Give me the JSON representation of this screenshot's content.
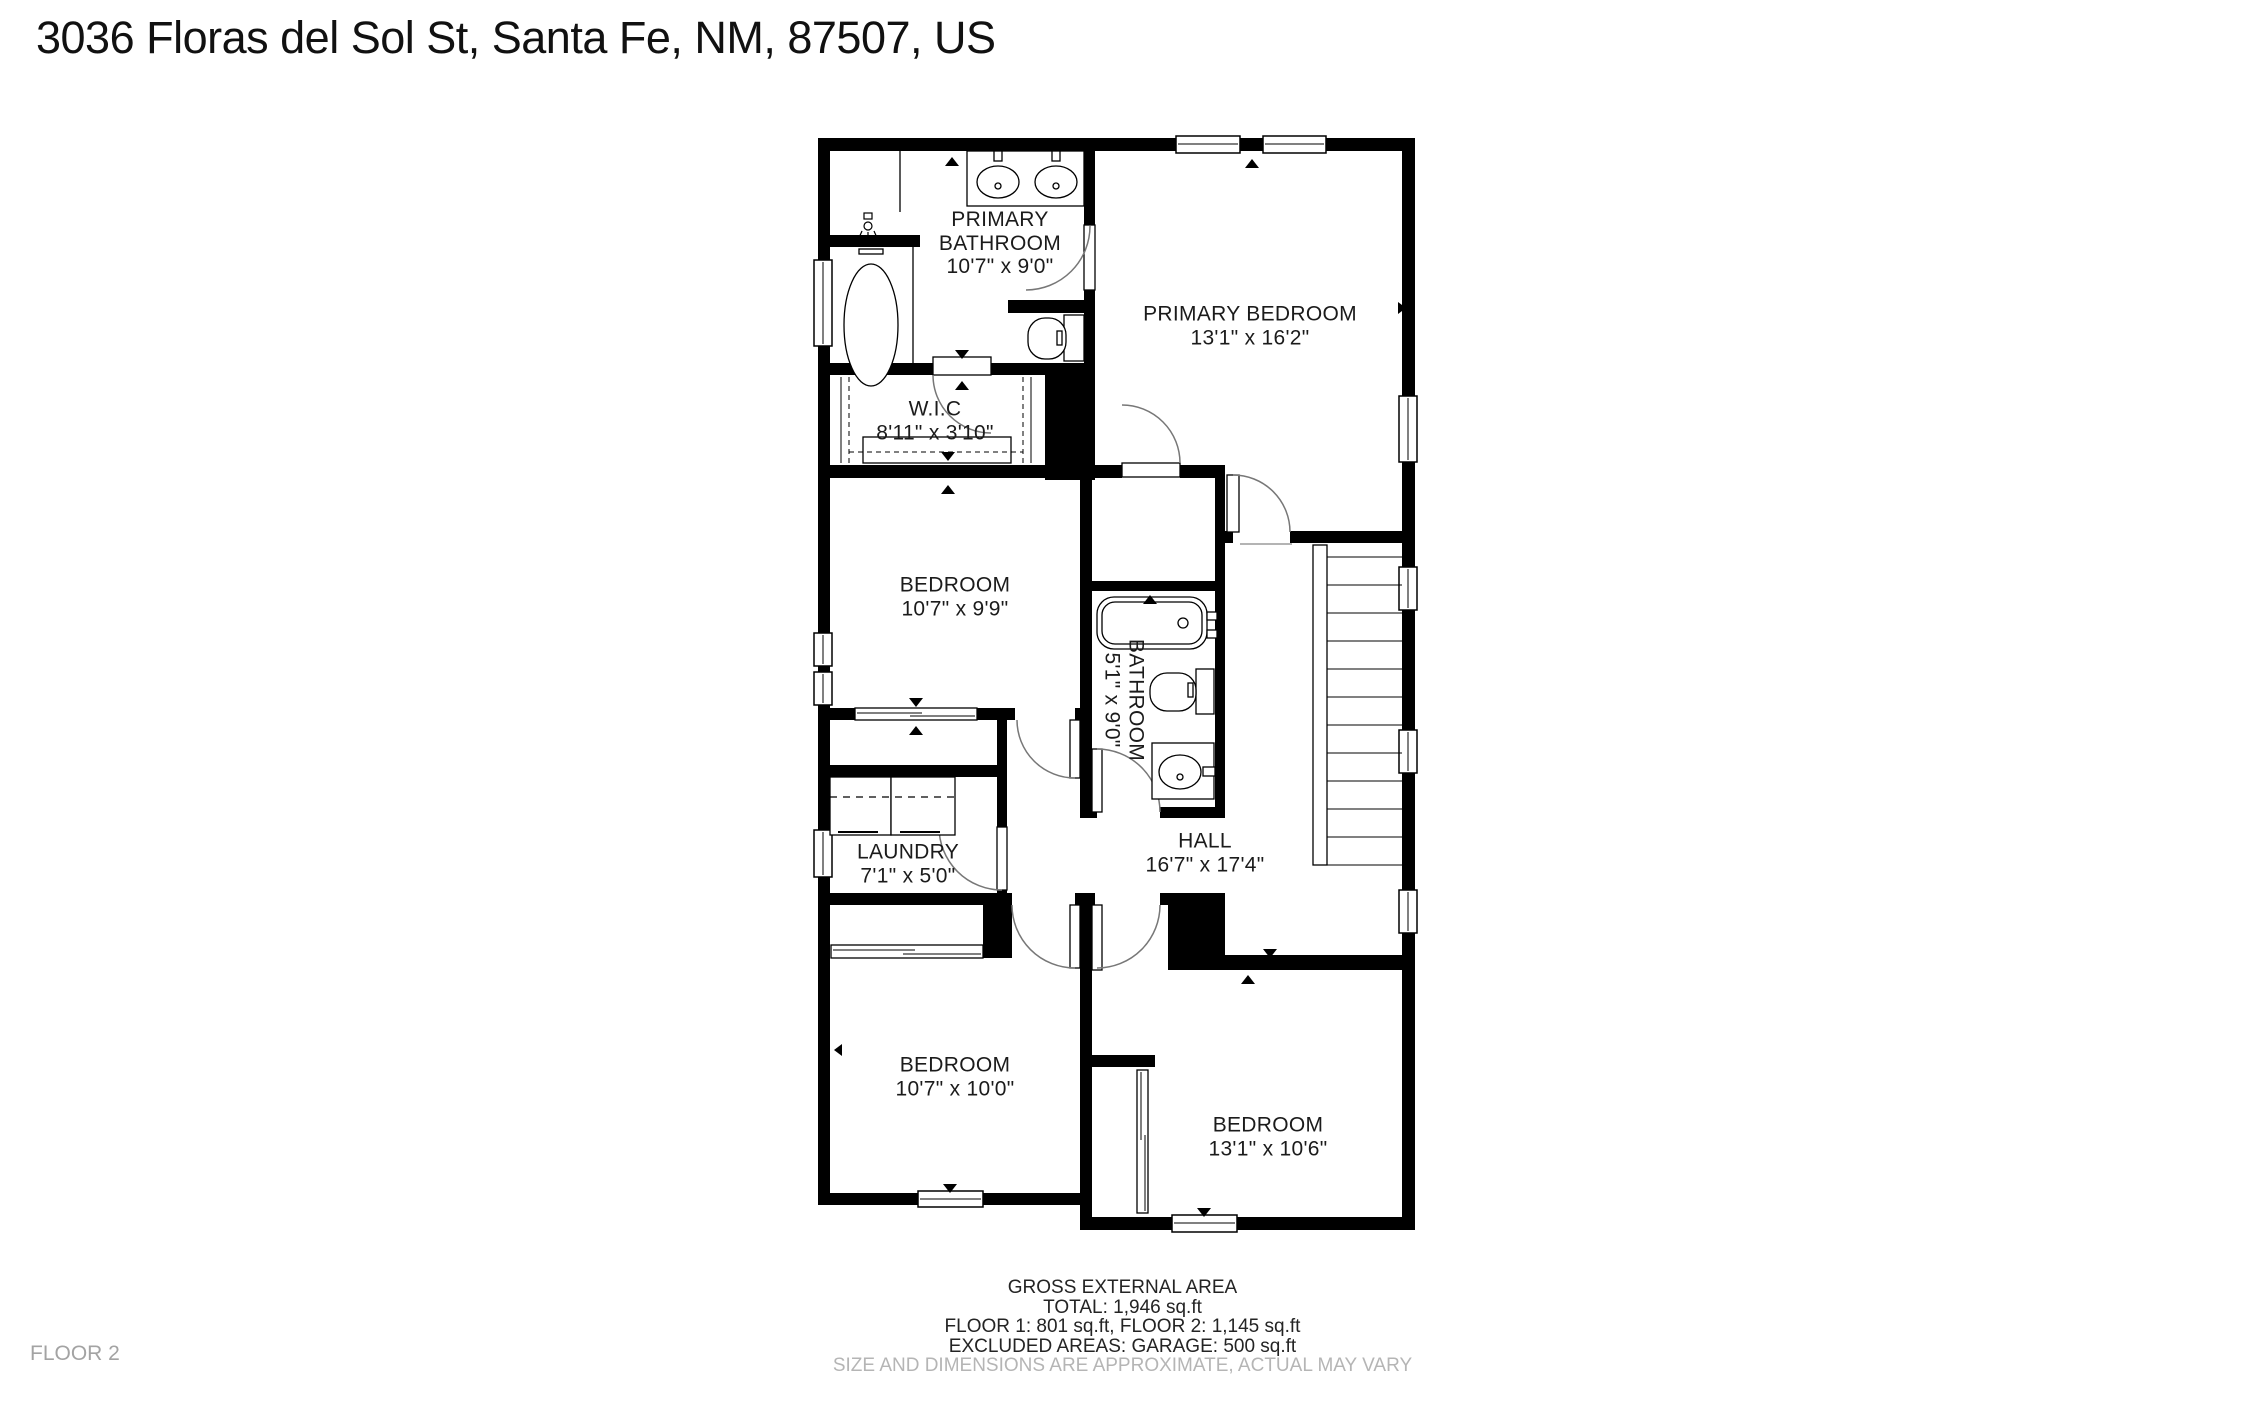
{
  "title": "3036 Floras del Sol St, Santa Fe, NM, 87507, US",
  "floor_label": "FLOOR 2",
  "rooms": [
    {
      "id": "primary-bathroom",
      "name": "PRIMARY BATHROOM",
      "dims": "10'7\" x 9'0\""
    },
    {
      "id": "primary-bedroom",
      "name": "PRIMARY BEDROOM",
      "dims": "13'1\" x 16'2\""
    },
    {
      "id": "wic",
      "name": "W.I.C",
      "dims": "8'11\" x 3'10\""
    },
    {
      "id": "bedroom-middle",
      "name": "BEDROOM",
      "dims": "10'7\" x 9'9\""
    },
    {
      "id": "bathroom",
      "name": "BATHROOM",
      "dims": "5'1\" x 9'0\""
    },
    {
      "id": "laundry",
      "name": "LAUNDRY",
      "dims": "7'1\" x 5'0\""
    },
    {
      "id": "hall",
      "name": "HALL",
      "dims": "16'7\" x 17'4\""
    },
    {
      "id": "bedroom-bottom-left",
      "name": "BEDROOM",
      "dims": "10'7\" x 10'0\""
    },
    {
      "id": "bedroom-bottom-right",
      "name": "BEDROOM",
      "dims": "13'1\" x 10'6\""
    }
  ],
  "footer": {
    "heading": "GROSS EXTERNAL AREA",
    "total": "TOTAL: 1,946 sq.ft",
    "floors": "FLOOR 1: 801 sq.ft, FLOOR 2: 1,145 sq.ft",
    "excluded": "EXCLUDED AREAS: GARAGE: 500 sq.ft",
    "disclaimer": "SIZE AND DIMENSIONS ARE APPROXIMATE, ACTUAL MAY VARY"
  },
  "colors": {
    "wall": "#000000",
    "text": "#1b1b1b",
    "muted": "#b5b5b5",
    "floor_label": "#a3a3a3",
    "arc": "#777777"
  }
}
